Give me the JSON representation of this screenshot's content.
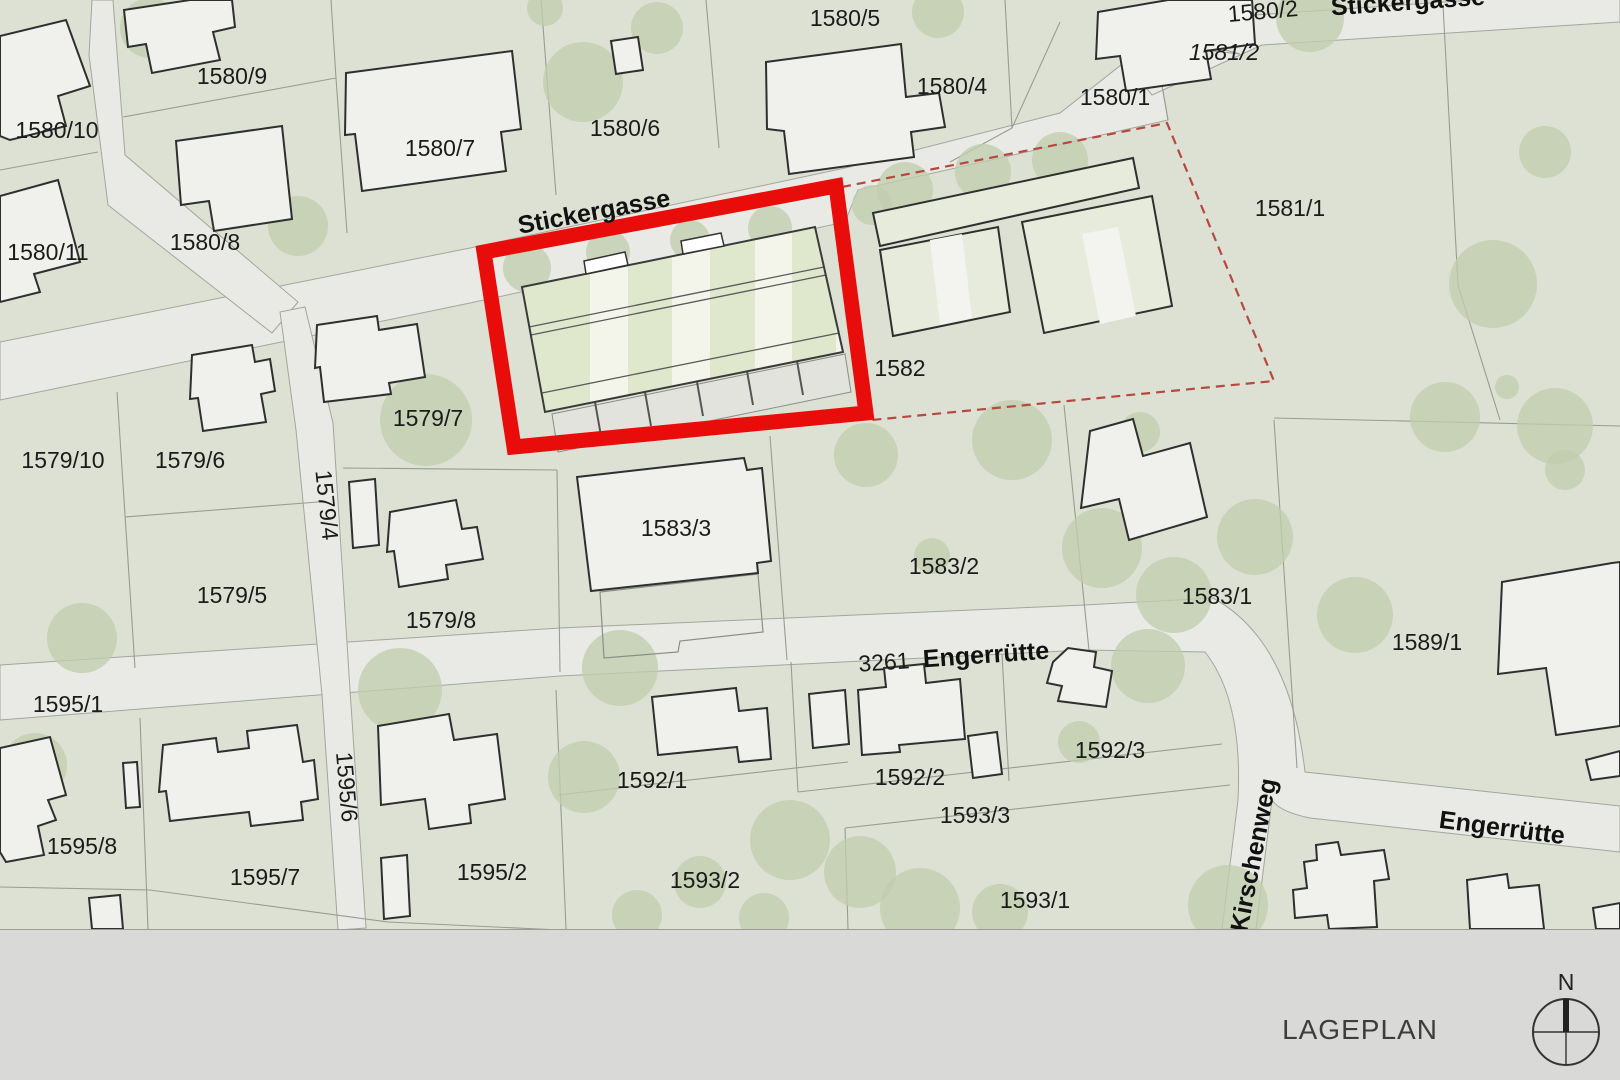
{
  "page": {
    "title": "LAGEPLAN",
    "compass_north": "N"
  },
  "colors": {
    "parcel_green": "#dde1d3",
    "street_gray": "#e9eae5",
    "tree_green": "#c2cdae",
    "building_fill": "#f0f1ed",
    "building_outline": "#2f2f2f",
    "existing_roof_green": "#e7ebdb",
    "new_roof_base": "#f3f5eb",
    "new_roof_stripe": "#dfe7cd",
    "highlight_red": "#e80d0a",
    "dashed_red": "#b5483f",
    "footer_gray": "#d9dad8"
  },
  "map": {
    "street_labels": [
      {
        "name": "Stickergasse"
      },
      {
        "name": "Engerrütte"
      },
      {
        "name": "3261"
      },
      {
        "name": "Engerrütte"
      },
      {
        "name": "Kirschenweg"
      },
      {
        "name": "Stickergasse"
      }
    ],
    "parcel_labels": [
      {
        "id": "1580/9"
      },
      {
        "id": "1580/10"
      },
      {
        "id": "1580/11"
      },
      {
        "id": "1580/8"
      },
      {
        "id": "1580/7"
      },
      {
        "id": "1580/6"
      },
      {
        "id": "1580/5"
      },
      {
        "id": "1580/4"
      },
      {
        "id": "1580/1"
      },
      {
        "id": "1580/2"
      },
      {
        "id": "1581/2"
      },
      {
        "id": "1581/1"
      },
      {
        "id": "1582"
      },
      {
        "id": "1579/7"
      },
      {
        "id": "1579/10"
      },
      {
        "id": "1579/6"
      },
      {
        "id": "1579/4"
      },
      {
        "id": "1579/5"
      },
      {
        "id": "1579/8"
      },
      {
        "id": "1583/3"
      },
      {
        "id": "1583/2"
      },
      {
        "id": "1583/1"
      },
      {
        "id": "1589/1"
      },
      {
        "id": "1595/1"
      },
      {
        "id": "1595/8"
      },
      {
        "id": "1595/7"
      },
      {
        "id": "1595/6"
      },
      {
        "id": "1595/2"
      },
      {
        "id": "1592/1"
      },
      {
        "id": "1592/2"
      },
      {
        "id": "1592/3"
      },
      {
        "id": "1593/3"
      },
      {
        "id": "1593/2"
      },
      {
        "id": "1593/1"
      }
    ]
  }
}
